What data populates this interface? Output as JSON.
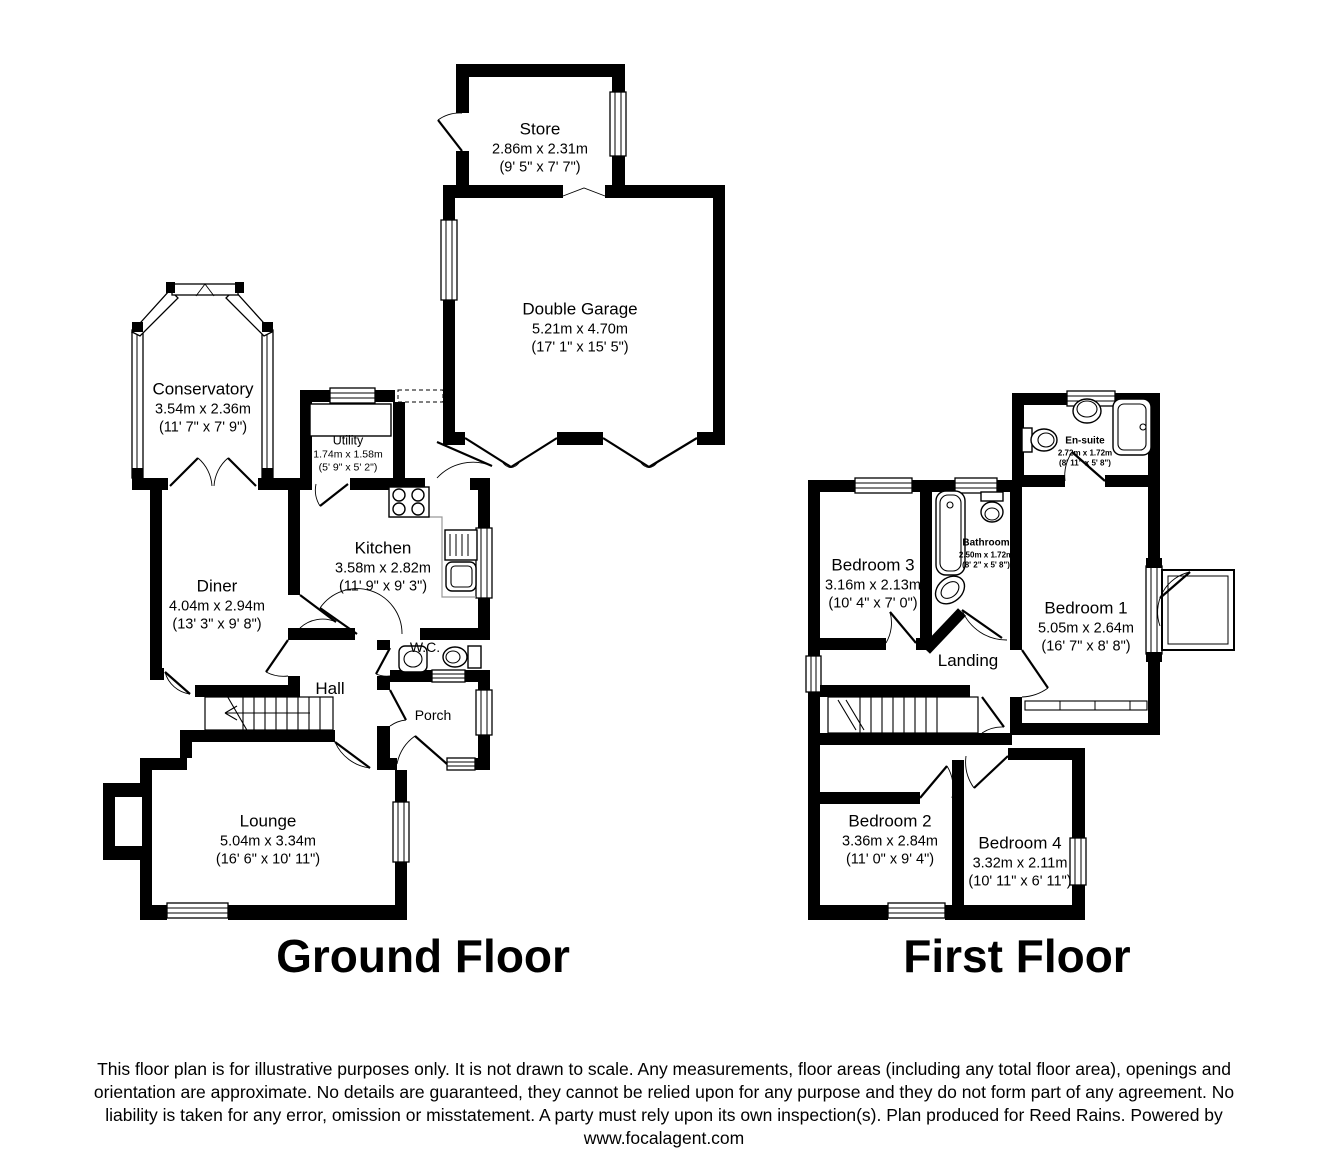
{
  "ground_floor": {
    "title": "Ground Floor",
    "rooms": {
      "store": {
        "name": "Store",
        "metric": "2.86m x 2.31m",
        "imperial": "(9' 5\" x 7' 7\")"
      },
      "double_garage": {
        "name": "Double Garage",
        "metric": "5.21m x 4.70m",
        "imperial": "(17' 1\" x 15' 5\")"
      },
      "conservatory": {
        "name": "Conservatory",
        "metric": "3.54m x 2.36m",
        "imperial": "(11' 7\" x 7' 9\")"
      },
      "utility": {
        "name": "Utility",
        "metric": "1.74m x 1.58m",
        "imperial": "(5' 9\" x 5' 2\")"
      },
      "kitchen": {
        "name": "Kitchen",
        "metric": "3.58m x 2.82m",
        "imperial": "(11' 9\" x 9' 3\")"
      },
      "diner": {
        "name": "Diner",
        "metric": "4.04m x 2.94m",
        "imperial": "(13' 3\" x 9' 8\")"
      },
      "wc": {
        "name": "W.C."
      },
      "hall": {
        "name": "Hall"
      },
      "porch": {
        "name": "Porch"
      },
      "lounge": {
        "name": "Lounge",
        "metric": "5.04m x 3.34m",
        "imperial": "(16' 6\" x 10' 11\")"
      }
    }
  },
  "first_floor": {
    "title": "First Floor",
    "rooms": {
      "bedroom3": {
        "name": "Bedroom 3",
        "metric": "3.16m x 2.13m",
        "imperial": "(10' 4\" x 7' 0\")"
      },
      "bathroom": {
        "name": "Bathroom",
        "metric": "2.50m x 1.72m",
        "imperial": "(8' 2\" x 5' 8\")"
      },
      "ensuite": {
        "name": "En-suite",
        "metric": "2.72m x 1.72m",
        "imperial": "(8' 11\" x 5' 8\")"
      },
      "bedroom1": {
        "name": "Bedroom 1",
        "metric": "5.05m x 2.64m",
        "imperial": "(16' 7\" x 8' 8\")"
      },
      "landing": {
        "name": "Landing"
      },
      "bedroom2": {
        "name": "Bedroom 2",
        "metric": "3.36m x 2.84m",
        "imperial": "(11' 0\" x 9' 4\")"
      },
      "bedroom4": {
        "name": "Bedroom 4",
        "metric": "3.32m x 2.11m",
        "imperial": "(10' 11\" x 6' 11\")"
      }
    }
  },
  "disclaimer": {
    "lines": [
      "This floor plan is for illustrative purposes only. It is not drawn to scale. Any measurements, floor areas (including any total floor area), openings and",
      "orientation are approximate. No details are guaranteed, they cannot be relied upon for any purpose and they do not form part of any agreement. No",
      "liability is taken for any error, omission or misstatement. A party must rely upon its own inspection(s). Plan produced for Reed Rains. Powered by",
      "www.focalagent.com"
    ]
  },
  "colors": {
    "wall": "#000000",
    "floor": "#ffffff",
    "text": "#000000"
  }
}
